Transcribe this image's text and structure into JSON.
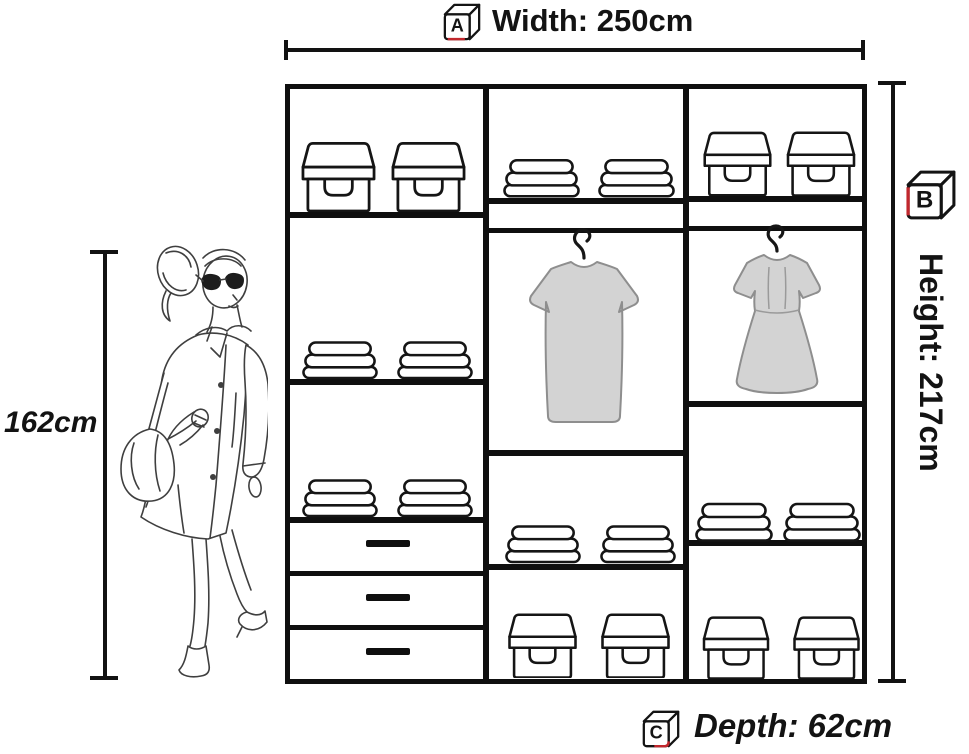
{
  "title": "Wardrobe dimensions diagram",
  "labels": {
    "width": "Width: 250cm",
    "height": "Height: 217cm",
    "depth": "Depth: 62cm",
    "person_height": "162cm"
  },
  "cube_markers": {
    "width": "A",
    "height": "B",
    "depth": "C"
  },
  "colors": {
    "line": "#121212",
    "accent_red": "#c1272d",
    "garment_fill": "#d3d3d3",
    "garment_outline": "#8e8e8e",
    "sketch_stroke": "#3f3f3f"
  },
  "figure": {
    "description": "pencil sketch of a walking woman in a long coat with sunglasses and a handbag, used as height reference"
  },
  "wardrobe": {
    "columns": [
      {
        "id": "left",
        "sections": [
          {
            "type": "shelf",
            "items": [
              "storage-box",
              "storage-box"
            ]
          },
          {
            "type": "shelf",
            "items": [
              "folded-stack",
              "folded-stack"
            ]
          },
          {
            "type": "shelf",
            "items": [
              "folded-stack",
              "folded-stack"
            ]
          },
          {
            "type": "drawer"
          },
          {
            "type": "drawer"
          },
          {
            "type": "drawer"
          }
        ]
      },
      {
        "id": "middle",
        "sections": [
          {
            "type": "shelf",
            "items": [
              "folded-stack",
              "folded-stack"
            ]
          },
          {
            "type": "hanging-rail",
            "items": [
              "straight-dress"
            ]
          },
          {
            "type": "shelf",
            "items": [
              "folded-stack",
              "folded-stack"
            ]
          },
          {
            "type": "shelf",
            "items": [
              "storage-box",
              "storage-box"
            ]
          }
        ]
      },
      {
        "id": "right",
        "sections": [
          {
            "type": "shelf",
            "items": [
              "storage-box",
              "storage-box"
            ]
          },
          {
            "type": "hanging-rail",
            "items": [
              "flared-dress"
            ]
          },
          {
            "type": "shelf",
            "items": [
              "folded-stack",
              "folded-stack"
            ]
          },
          {
            "type": "shelf",
            "items": [
              "storage-box",
              "storage-box"
            ]
          }
        ]
      }
    ]
  }
}
